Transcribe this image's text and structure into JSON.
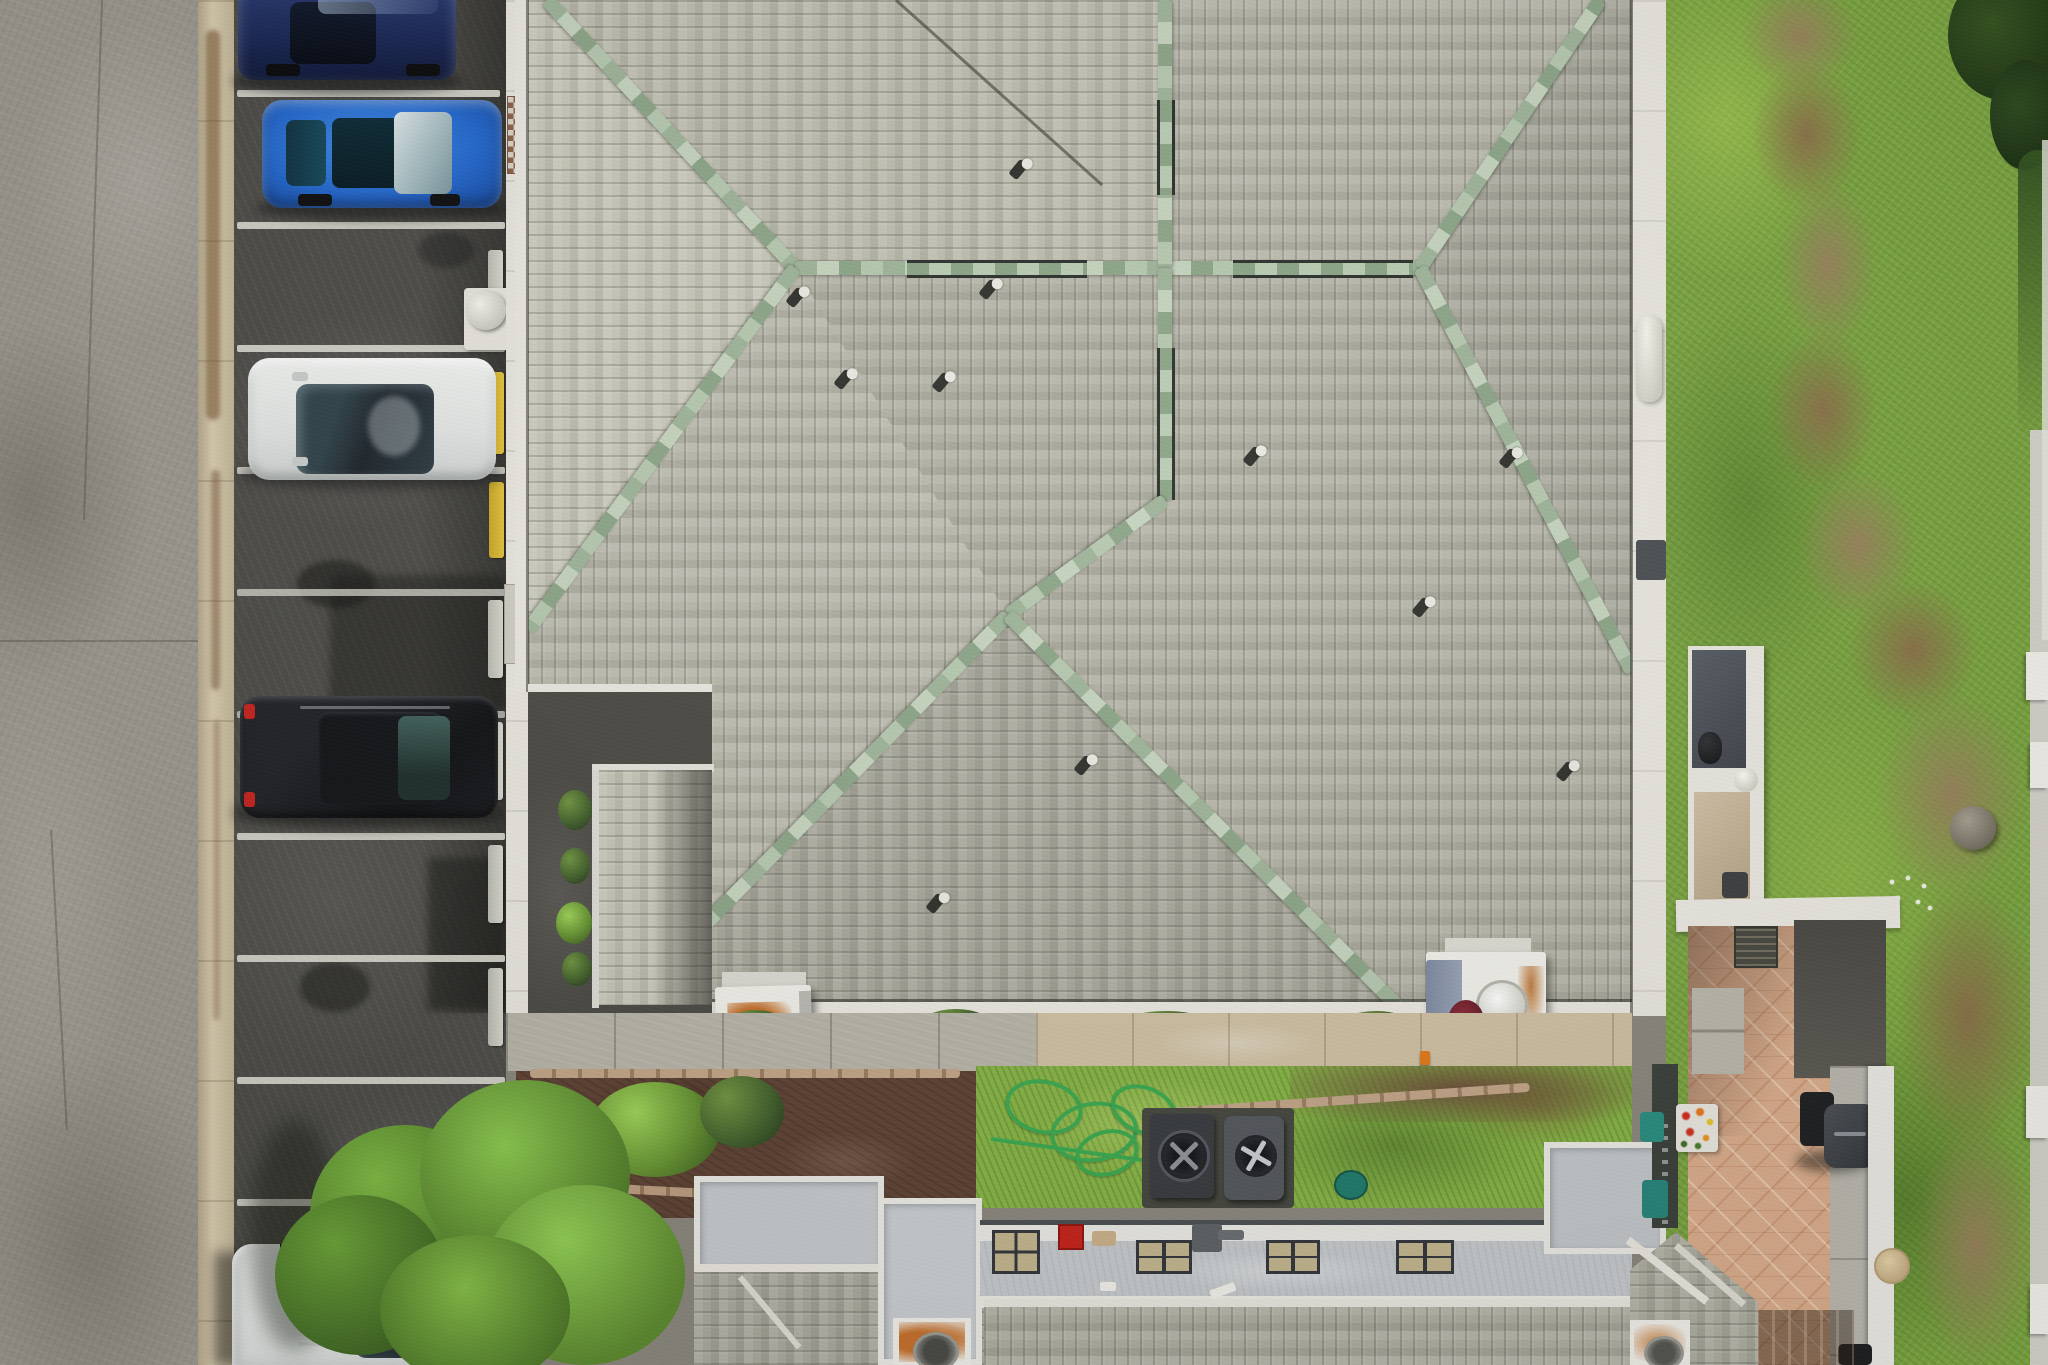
{
  "scene": {
    "type": "aerial-drone-photograph",
    "view": "top-down",
    "setting": "multi-unit residential building with grey-green hip shingle roof, parking lot at left, gardens and patios below, patchy lawn at right"
  },
  "palette": {
    "roof_shingle": "#b2b2a6",
    "ridge_cap_green": "#a9bea3",
    "asphalt": "#4c4b47",
    "concrete_strip": "#9c988f",
    "curb": "#cfc2a6",
    "stall_line": "#d8d8cf",
    "grass": "#7aa440",
    "dirt_path": "#97825a",
    "mulch": "#5e4233",
    "paver": "#d9ac8b",
    "flat_roof": "#c5c9cc",
    "chimney_rust": "#c4702c",
    "hose_green": "#3aa84f"
  },
  "parking_lot": {
    "stall_lines_visible": 10,
    "cars": [
      {
        "position": "top",
        "color": "dark navy blue"
      },
      {
        "position": "second",
        "color": "bright blue"
      },
      {
        "position": "middle",
        "color": "white"
      },
      {
        "position": "lower",
        "color": "black"
      },
      {
        "position": "bottom",
        "color": "white"
      }
    ],
    "wheel_stops_concrete": 6,
    "wheel_stops_yellow": 2,
    "bollard": "white pipe bollard on concrete pad",
    "doormat": "brown and cream checkered mat on walkway"
  },
  "roof": {
    "shingles": "grey-green architectural asphalt, mixed course directions",
    "ridge_caps": "pale sage green, some sections edged dark",
    "main_ridge": "horizontal with cross junction and radiating hips",
    "roof_vents": 11,
    "valley": "dark diagonal valley upper middle"
  },
  "chimneys": [
    {
      "location": "lower-left eave",
      "color": "white with rust-orange staining",
      "flue": "dark round"
    },
    {
      "location": "lower-right eave",
      "color": "white with slate-blue shaded side",
      "vent": "white cylinder",
      "stain": "rust streaks"
    },
    {
      "location": "bottom-center building",
      "color": "white with rust-orange staining",
      "flue": "grey round"
    },
    {
      "location": "bottom-right corner roof",
      "color": "white with rust-orange staining",
      "flue": "grey round"
    }
  ],
  "grounds": {
    "garden_hose": "green, tangled coils",
    "ac_units": 2,
    "hose_reel": "teal disc",
    "tree": "large bright green canopy at bottom left",
    "shrub_row": "dark green bushes along eave",
    "red_shrub": "small dark red plant near right chimney"
  },
  "bottom_building": {
    "flat_roof": "light grey with white parapets",
    "skylights": 4,
    "red_box": 1,
    "ducts": "grey roof ducts",
    "pitched_roofs": "grey shingle with white ridge boards"
  },
  "patio": {
    "pavers": "salmon pink with leaf motif",
    "grill": "dark gas grill with cart",
    "railing": "white",
    "walkway": "light concrete",
    "planter": "red, orange and yellow flowers in white box",
    "bins": "teal",
    "table": "round beige",
    "balconies": "white parapets with dark and tan openings"
  },
  "lawn": {
    "condition": "patchy green with winding dirt path",
    "rock": 1,
    "white_flowers": "small cluster",
    "trees_top_right": "dark green canopy"
  }
}
